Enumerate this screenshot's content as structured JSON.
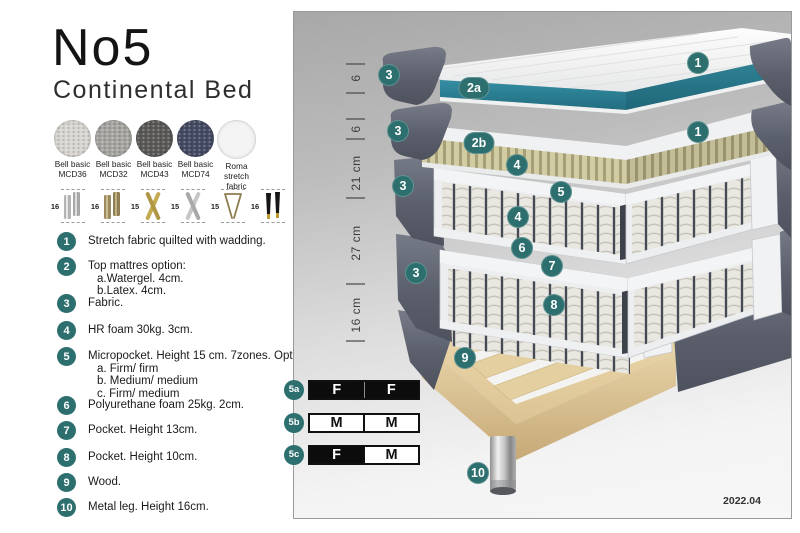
{
  "header": {
    "title": "No5",
    "subtitle": "Continental Bed"
  },
  "swatches": [
    {
      "line1": "Bell basic",
      "line2": "MCD36",
      "color": "#d8d5d0"
    },
    {
      "line1": "Bell basic",
      "line2": "MCD32",
      "color": "#a7a5a1"
    },
    {
      "line1": "Bell basic",
      "line2": "MCD43",
      "color": "#5b5a58"
    },
    {
      "line1": "Bell basic",
      "line2": "MCD74",
      "color": "#454b63"
    },
    {
      "line1": "Roma",
      "line2": "stretch fabric",
      "color": "#f4f4f4"
    }
  ],
  "legs": [
    {
      "height": "16",
      "type": "cylinder-silver"
    },
    {
      "height": "16",
      "type": "cylinder-bronze"
    },
    {
      "height": "15",
      "type": "cross-gold"
    },
    {
      "height": "15",
      "type": "cross-silver"
    },
    {
      "height": "15",
      "type": "hairpin"
    },
    {
      "height": "16",
      "type": "cone-black-gold"
    }
  ],
  "legend": {
    "items": [
      {
        "num": "1",
        "lines": [
          "Stretch fabric quilted with wadding."
        ]
      },
      {
        "num": "2",
        "lines": [
          "Top mattres option:",
          "a.Watergel. 4cm.",
          "b.Latex. 4cm."
        ]
      },
      {
        "num": "3",
        "lines": [
          "Fabric."
        ]
      },
      {
        "num": "4",
        "lines": [
          "HR foam 30kg. 3cm."
        ]
      },
      {
        "num": "5",
        "lines": [
          "Micropocket. Height 15 cm. 7zones. Option:",
          "a. Firm/ firm",
          "b. Medium/ medium",
          "c. Firm/ medium"
        ]
      },
      {
        "num": "6",
        "lines": [
          "Polyurethane foam 25kg. 2cm."
        ]
      },
      {
        "num": "7",
        "lines": [
          "Pocket. Height 13cm."
        ]
      },
      {
        "num": "8",
        "lines": [
          "Pocket. Height 10cm."
        ]
      },
      {
        "num": "9",
        "lines": [
          "Wood."
        ]
      },
      {
        "num": "10",
        "lines": [
          "Metal leg. Height 16cm."
        ]
      }
    ]
  },
  "diagram": {
    "measurements": [
      "6",
      "6",
      "21 cm",
      "27 cm",
      "16 cm"
    ],
    "callouts": {
      "c1": "1",
      "c2a": "2a",
      "c2b": "2b",
      "c3": "3",
      "c4": "4",
      "c5": "5",
      "c6": "6",
      "c7": "7",
      "c8": "8",
      "c9": "9",
      "c10": "10"
    },
    "firmness": {
      "rows": [
        {
          "id": "5a",
          "left": {
            "label": "F",
            "filled": true
          },
          "right": {
            "label": "F",
            "filled": true
          }
        },
        {
          "id": "5b",
          "left": {
            "label": "M",
            "filled": false
          },
          "right": {
            "label": "M",
            "filled": false
          }
        },
        {
          "id": "5c",
          "left": {
            "label": "F",
            "filled": true
          },
          "right": {
            "label": "M",
            "filled": false
          }
        }
      ]
    },
    "version": "2022.04",
    "colors": {
      "callout": "#2d6f6f",
      "watergel": "#2c7f93",
      "latex": "#d2cca3",
      "fabric": "#5d6270",
      "wood": "#e4d0a4"
    }
  }
}
